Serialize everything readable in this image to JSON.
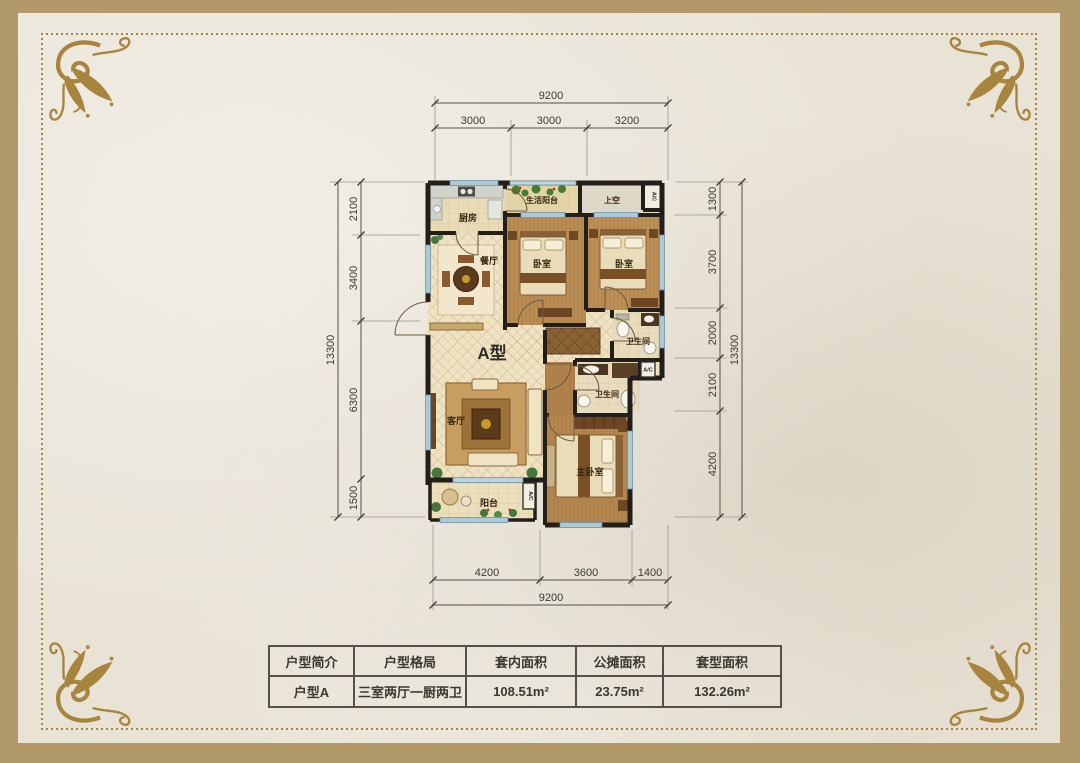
{
  "page": {
    "accent_gold": "#a8853f",
    "frame_gold": "#b2996a",
    "paper_color": "#e9e3d6",
    "wall_color": "#221e19"
  },
  "floor_plan": {
    "unit_label": "A型",
    "rooms": {
      "kitchen": "厨房",
      "laundry_balcony": "生活阳台",
      "void": "上空",
      "bedroom1": "卧室",
      "bedroom2": "卧室",
      "dining": "餐厅",
      "bath1": "卫生间",
      "bath2": "卫生间",
      "living": "客厅",
      "master": "主卧室",
      "balcony": "阳台",
      "ac": "A/C"
    },
    "dimensions": {
      "top": {
        "total": "9200",
        "segments": [
          "3000",
          "3000",
          "3200"
        ]
      },
      "bottom": {
        "total": "9200",
        "segments": [
          "4200",
          "3600",
          "1400"
        ]
      },
      "left": {
        "total": "13300",
        "segments": [
          "2100",
          "3400",
          "6300",
          "1500"
        ]
      },
      "right": {
        "total": "13300",
        "segments": [
          "1300",
          "3700",
          "2000",
          "2100",
          "4200"
        ]
      }
    }
  },
  "table": {
    "headers": [
      "户型简介",
      "户型格局",
      "套内面积",
      "公摊面积",
      "套型面积"
    ],
    "row": [
      "户型A",
      "三室两厅一厨两卫",
      "108.51m²",
      "23.75m²",
      "132.26m²"
    ]
  }
}
